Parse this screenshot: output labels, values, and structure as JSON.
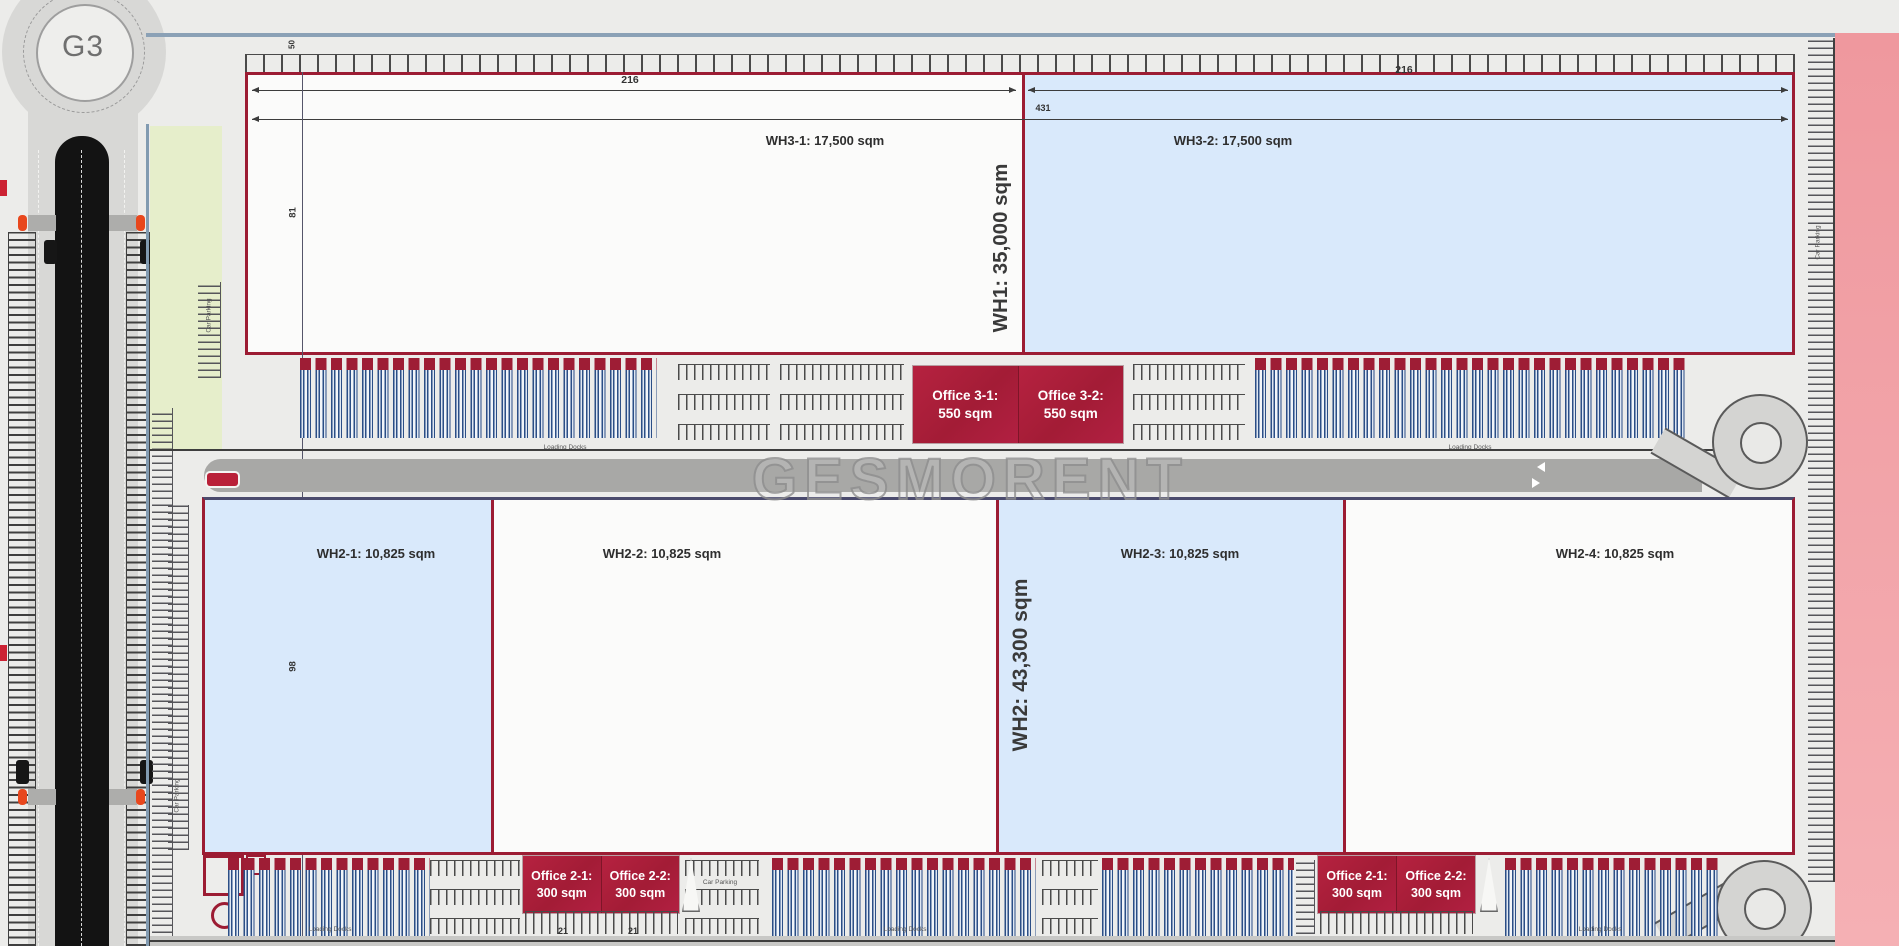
{
  "roundabout": {
    "label": "G3"
  },
  "watermark": {
    "text": "GESMORENT"
  },
  "wh1": {
    "vertical_label": "WH1: 35,000 sqm",
    "units": [
      {
        "label": "WH3-1: 17,500 sqm"
      },
      {
        "label": "WH3-2: 17,500 sqm"
      }
    ],
    "offices": [
      {
        "line1": "Office 3-1:",
        "line2": "550 sqm"
      },
      {
        "line1": "Office 3-2:",
        "line2": "550 sqm"
      }
    ]
  },
  "wh2": {
    "vertical_label": "WH2: 43,300 sqm",
    "units": [
      {
        "label": "WH2-1: 10,825 sqm"
      },
      {
        "label": "WH2-2: 10,825 sqm"
      },
      {
        "label": "WH2-3: 10,825 sqm"
      },
      {
        "label": "WH2-4: 10,825 sqm"
      }
    ],
    "office_pairs": [
      {
        "boxes": [
          {
            "line1": "Office 2-1:",
            "line2": "300 sqm"
          },
          {
            "line1": "Office 2-2:",
            "line2": "300 sqm"
          }
        ]
      },
      {
        "boxes": [
          {
            "line1": "Office 2-1:",
            "line2": "300 sqm"
          },
          {
            "line1": "Office 2-2:",
            "line2": "300 sqm"
          }
        ]
      }
    ]
  },
  "dimensions": {
    "wh3_1_width": "216",
    "wh3_2_width": "216",
    "wh1_total_width": "431",
    "wh1_depth": "81",
    "wh2_depth": "98",
    "front_setback": "50",
    "office_a_width": "21",
    "office_b_width": "21"
  },
  "captions": {
    "loading_docks": "Loading Docks",
    "car_parking": "Car Parking"
  },
  "colors": {
    "outline_red": "#9c1c33",
    "office_red": "#b01f3a",
    "unit_blue": "#d9e9fb",
    "pink_band": "#f2a0a6",
    "truck_navy": "#2b4e86",
    "road_line_blue": "#8ba1b6",
    "crosswalk_orange": "#e8471d"
  }
}
